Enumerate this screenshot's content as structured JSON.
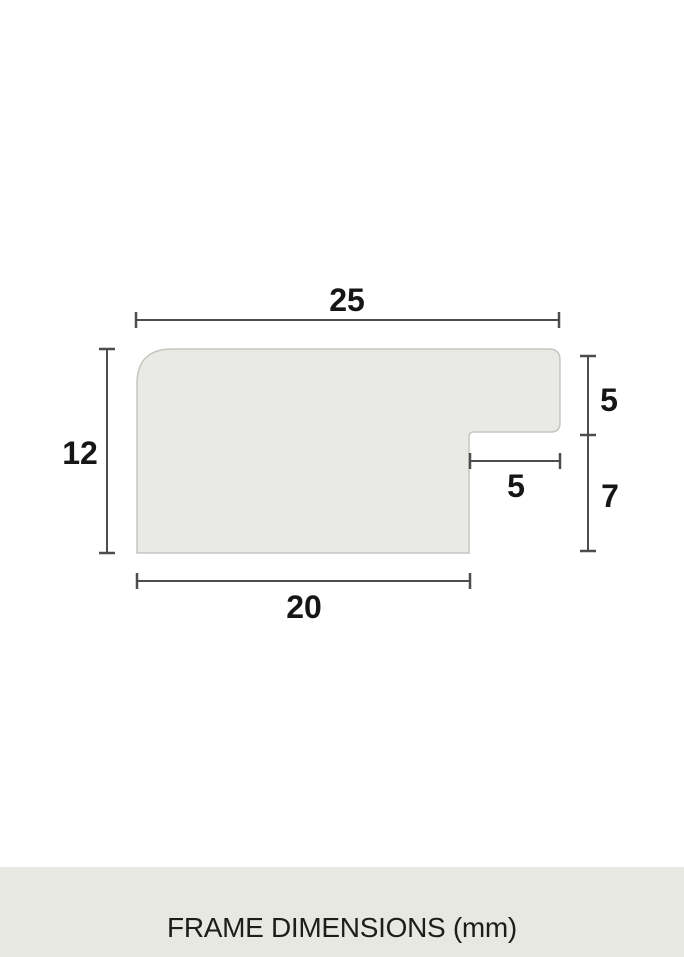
{
  "diagram": {
    "dimension_labels": {
      "top_width": "25",
      "left_height": "12",
      "right_upper_height": "5",
      "right_lower_height": "7",
      "rabbet_width": "5",
      "bottom_width": "20"
    },
    "unit": "mm"
  },
  "footer": {
    "label": "FRAME DIMENSIONS (mm)"
  },
  "colors": {
    "background": "#ffffff",
    "shape_fill": "#e9eae5",
    "shape_border": "#c5c6c1",
    "dimension_line": "#4d4d4d",
    "label_text": "#161616",
    "footer_background": "#e8e8e3",
    "footer_text": "#1d1d1b"
  }
}
